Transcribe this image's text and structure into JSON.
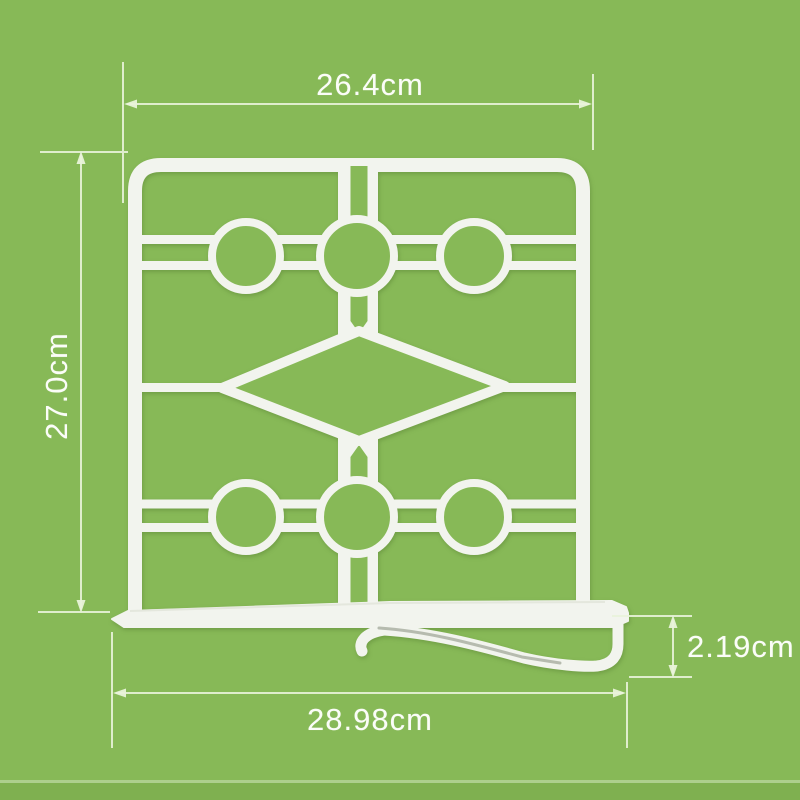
{
  "scene": {
    "background_color": "#87b957",
    "floor_band_color": "#7fb050",
    "product_color": "#f2f4ee",
    "dimension_line_color": "#e9f3da",
    "label_text_color": "#fbfdf8",
    "product_description": "White lattice shelf divider: rounded frame, two rows of three rings linked by double rails, center diamond, base rail with side mounting hook"
  },
  "dimension_labels": {
    "top_width": "26.4cm",
    "side_height": "27.0cm",
    "hook_height": "2.19cm",
    "base_width": "28.98cm"
  }
}
